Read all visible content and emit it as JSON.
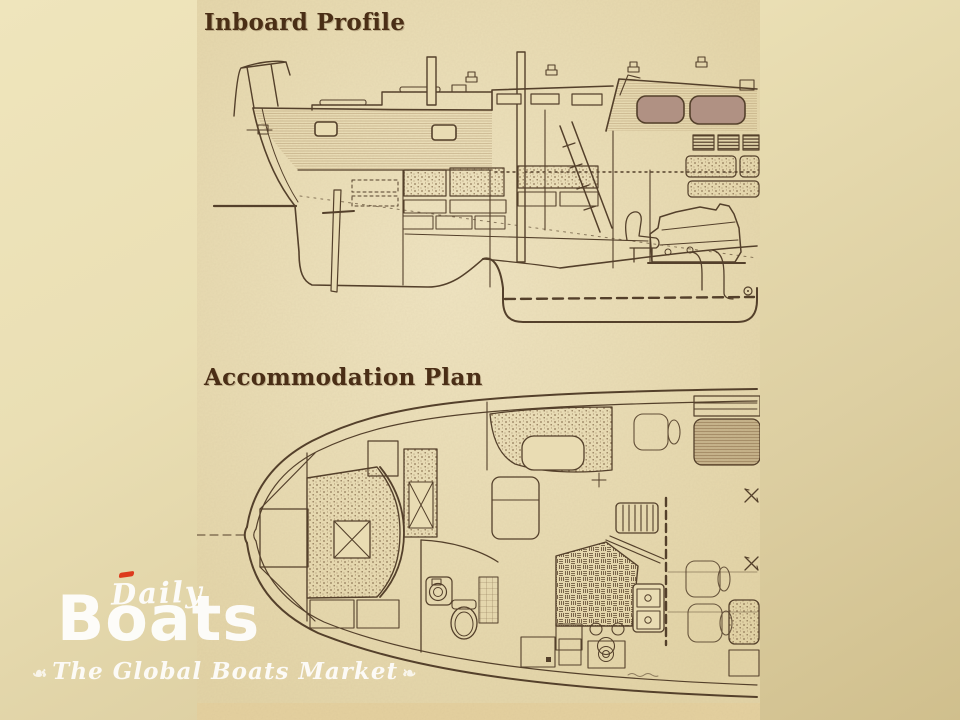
{
  "figure": {
    "titles": {
      "profile": "Inboard Profile",
      "plan": "Accommodation Plan"
    }
  },
  "watermark": {
    "brand_top": "Daily",
    "brand_main": "Boats",
    "tagline": "The Global Boats Market",
    "flourish_left": "☙",
    "flourish_right": "❧",
    "accent_color": "#dd3a1d",
    "text_color": "#ffffff"
  },
  "palette": {
    "background_beige": "#e3d6a9",
    "paper": "#e9dcb3",
    "ink": "#54402b",
    "window_tint": "#b09183"
  }
}
